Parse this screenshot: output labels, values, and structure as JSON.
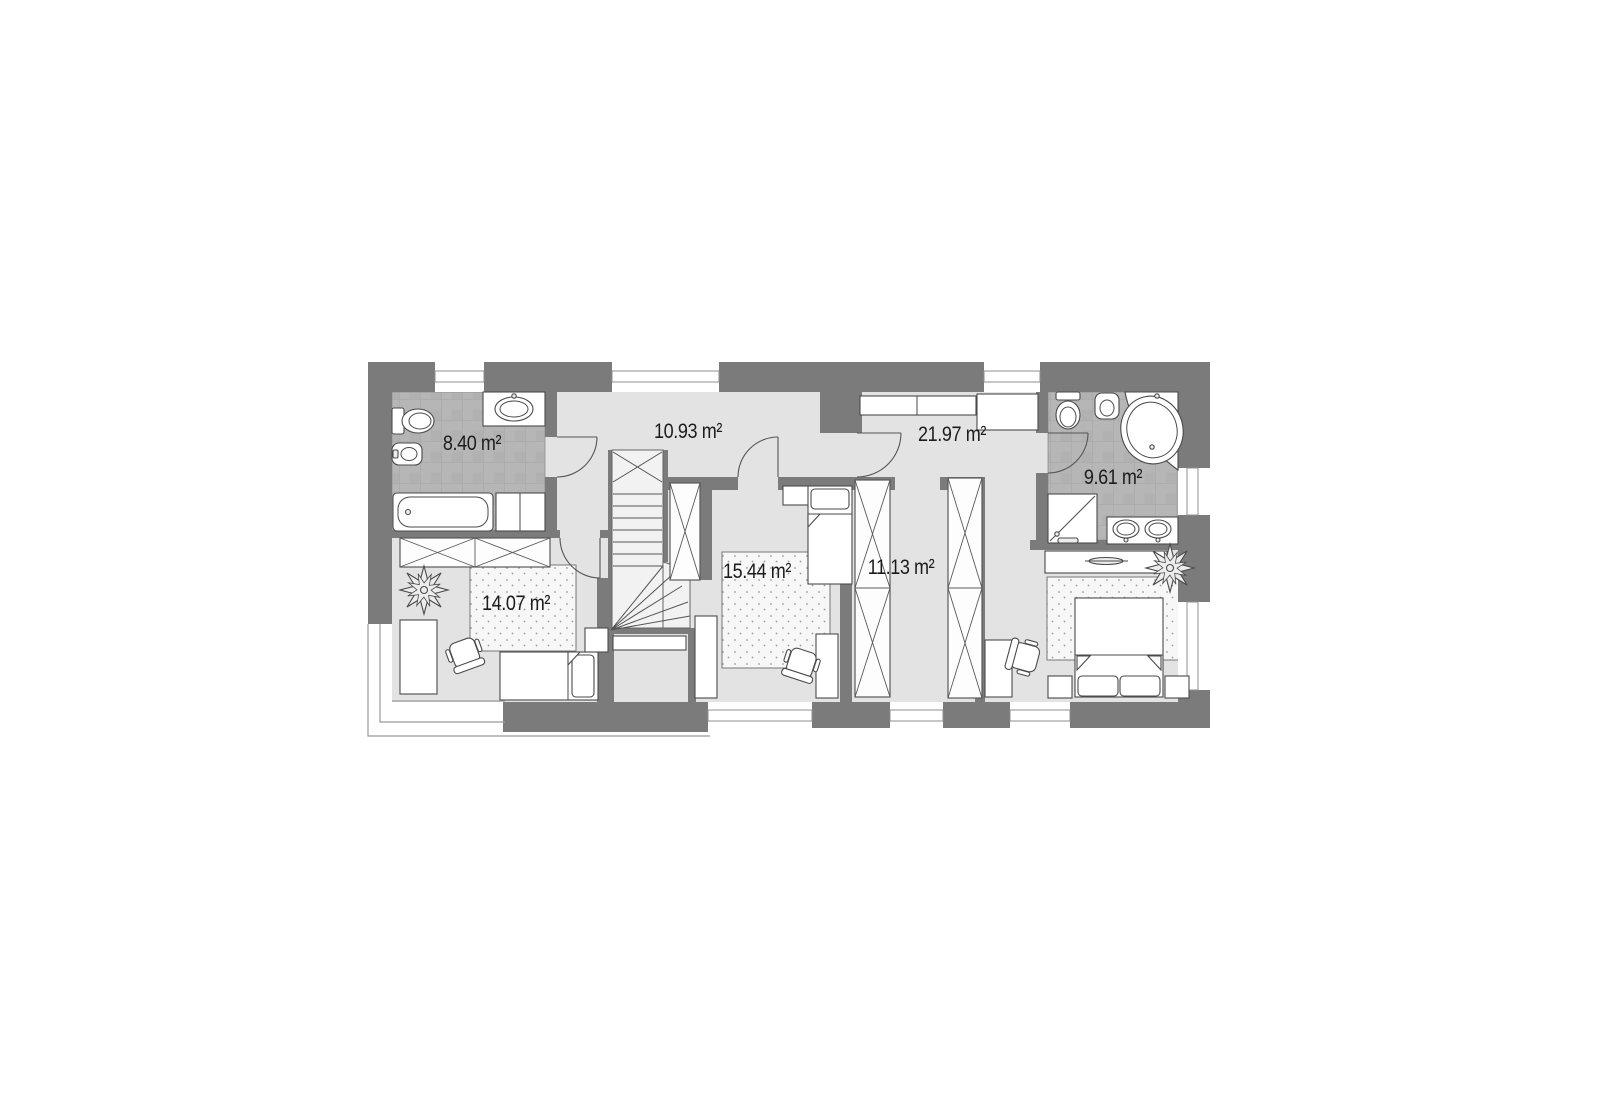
{
  "plan": {
    "type": "floor-plan",
    "floor_total_rooms": 7,
    "units": "m²"
  },
  "rooms": [
    {
      "id": "bathroom-small",
      "area": "8.40 m²",
      "fixtures": [
        "wall-hung-toilet",
        "bidet",
        "washbasin-counter",
        "bathtub",
        "bathroom-cabinet"
      ]
    },
    {
      "id": "hallway",
      "area": "10.93 m²",
      "fixtures": [
        "winder-staircase",
        "built-in-closet"
      ]
    },
    {
      "id": "bedroom-master",
      "area": "21.97 m²",
      "fixtures": [
        "wall-shelf",
        "low-cabinet",
        "sideboard",
        "double-bed",
        "nightstand-left",
        "nightstand-right",
        "rug",
        "desk",
        "desk-chair",
        "plant"
      ]
    },
    {
      "id": "bathroom-master",
      "area": "9.61 m²",
      "fixtures": [
        "toilet",
        "bidet",
        "corner-bathtub",
        "shower",
        "double-washbasin-counter"
      ]
    },
    {
      "id": "bedroom-middle",
      "area": "15.44 m²",
      "fixtures": [
        "single-bed",
        "nightstand",
        "rug",
        "desk",
        "desk-chair",
        "tall-cabinet"
      ]
    },
    {
      "id": "wardrobe",
      "area": "11.13 m²",
      "fixtures": [
        "wardrobe-closet-left",
        "wardrobe-closet-right"
      ]
    },
    {
      "id": "bedroom-left",
      "area": "14.07 m²",
      "fixtures": [
        "wardrobe-closet",
        "plant",
        "desk",
        "desk-chair",
        "rug",
        "single-bed",
        "nightstand"
      ]
    }
  ],
  "colors": {
    "wall": "#7b7b7b",
    "floor": "#e3e3e3",
    "bathroom_tile": "#b6b6b6",
    "furniture_outline": "#4a4a4a",
    "label_text": "#1c1c1c",
    "background": "#ffffff"
  }
}
